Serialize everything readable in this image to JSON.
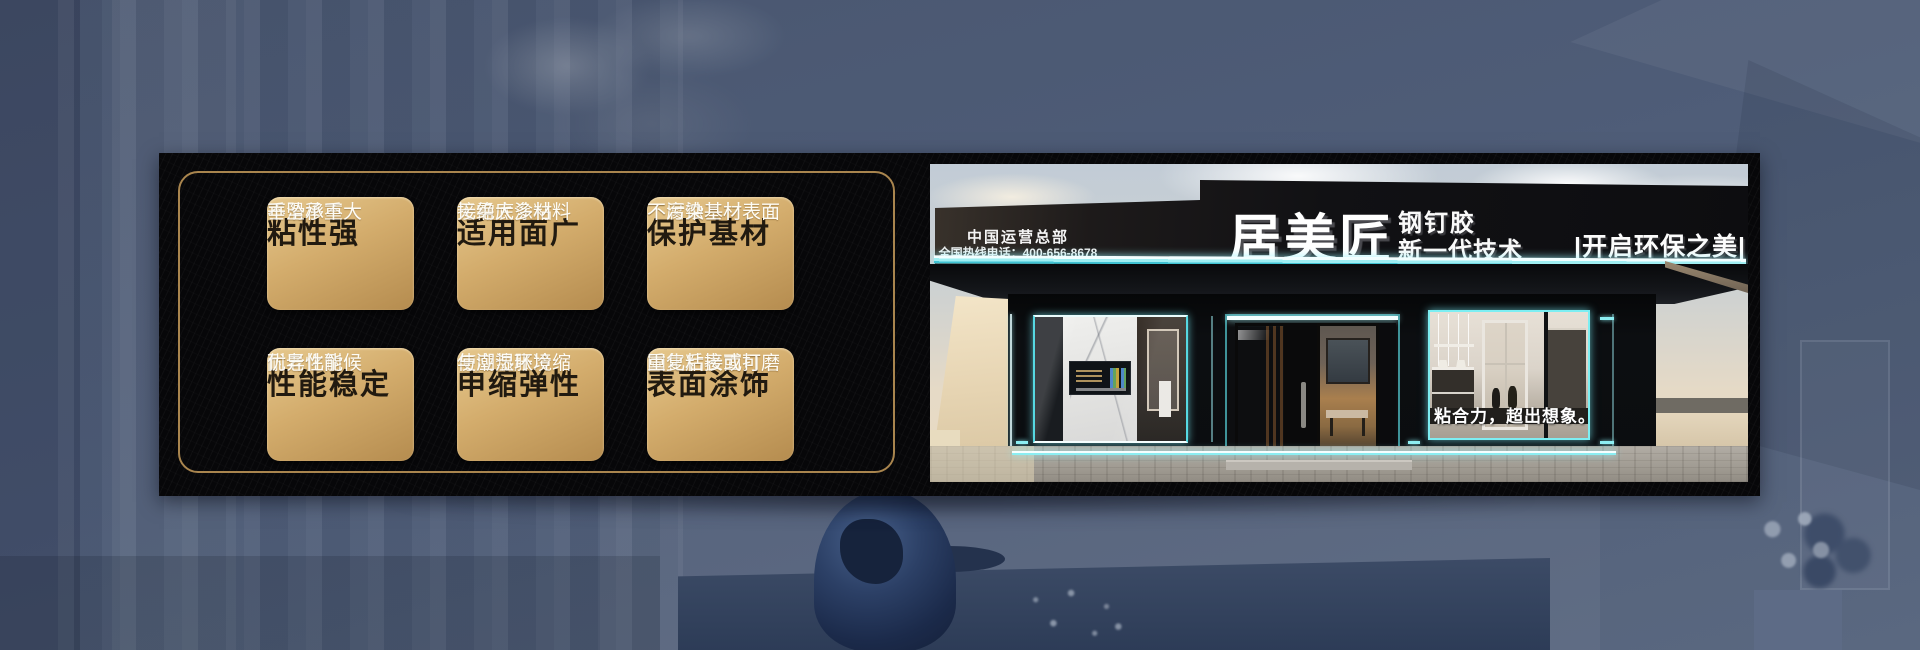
{
  "colors": {
    "accent_cyan": "#8FEFF4",
    "gold_border": "#A9854E",
    "card_gold_light": "#E6C88D",
    "card_gold_dark": "#B58C4F",
    "card_title_color": "#211A10",
    "card_body_color": "#FDFCF6",
    "billboard_black": "#070709",
    "background_slate": "#4E5C77",
    "sign_black": "#121114"
  },
  "feature_panel": {
    "cards": [
      {
        "title": "粘性强",
        "line1": "不滑移不",
        "line2": "垂坠承重大"
      },
      {
        "title": "适用面广",
        "line1": "无需底涂粘",
        "line2": "接绝大多材料"
      },
      {
        "title": "保护基材",
        "line1": "不腐蚀基材",
        "line2": "不污染基材表面"
      },
      {
        "title": "性能稳定",
        "line1": "耐老化耐候",
        "line2": "优异性能"
      },
      {
        "title": "申缩弹性",
        "line1": "使应热胀冷缩",
        "line2": "与潮湿环境"
      },
      {
        "title": "表面涂饰",
        "line1": "固化后表面可",
        "line2": "重复粘接或打磨"
      }
    ]
  },
  "storefront": {
    "sign": {
      "hq_title": "中国运营总部",
      "hotline": "全国热线电话：400-656-8678",
      "brand": "居美匠",
      "product": "钢钉胶",
      "tech_line": "新一代技术",
      "right_slogan": "|开启环保之美|"
    },
    "window_slogan": "粘合力，超出想象。"
  }
}
